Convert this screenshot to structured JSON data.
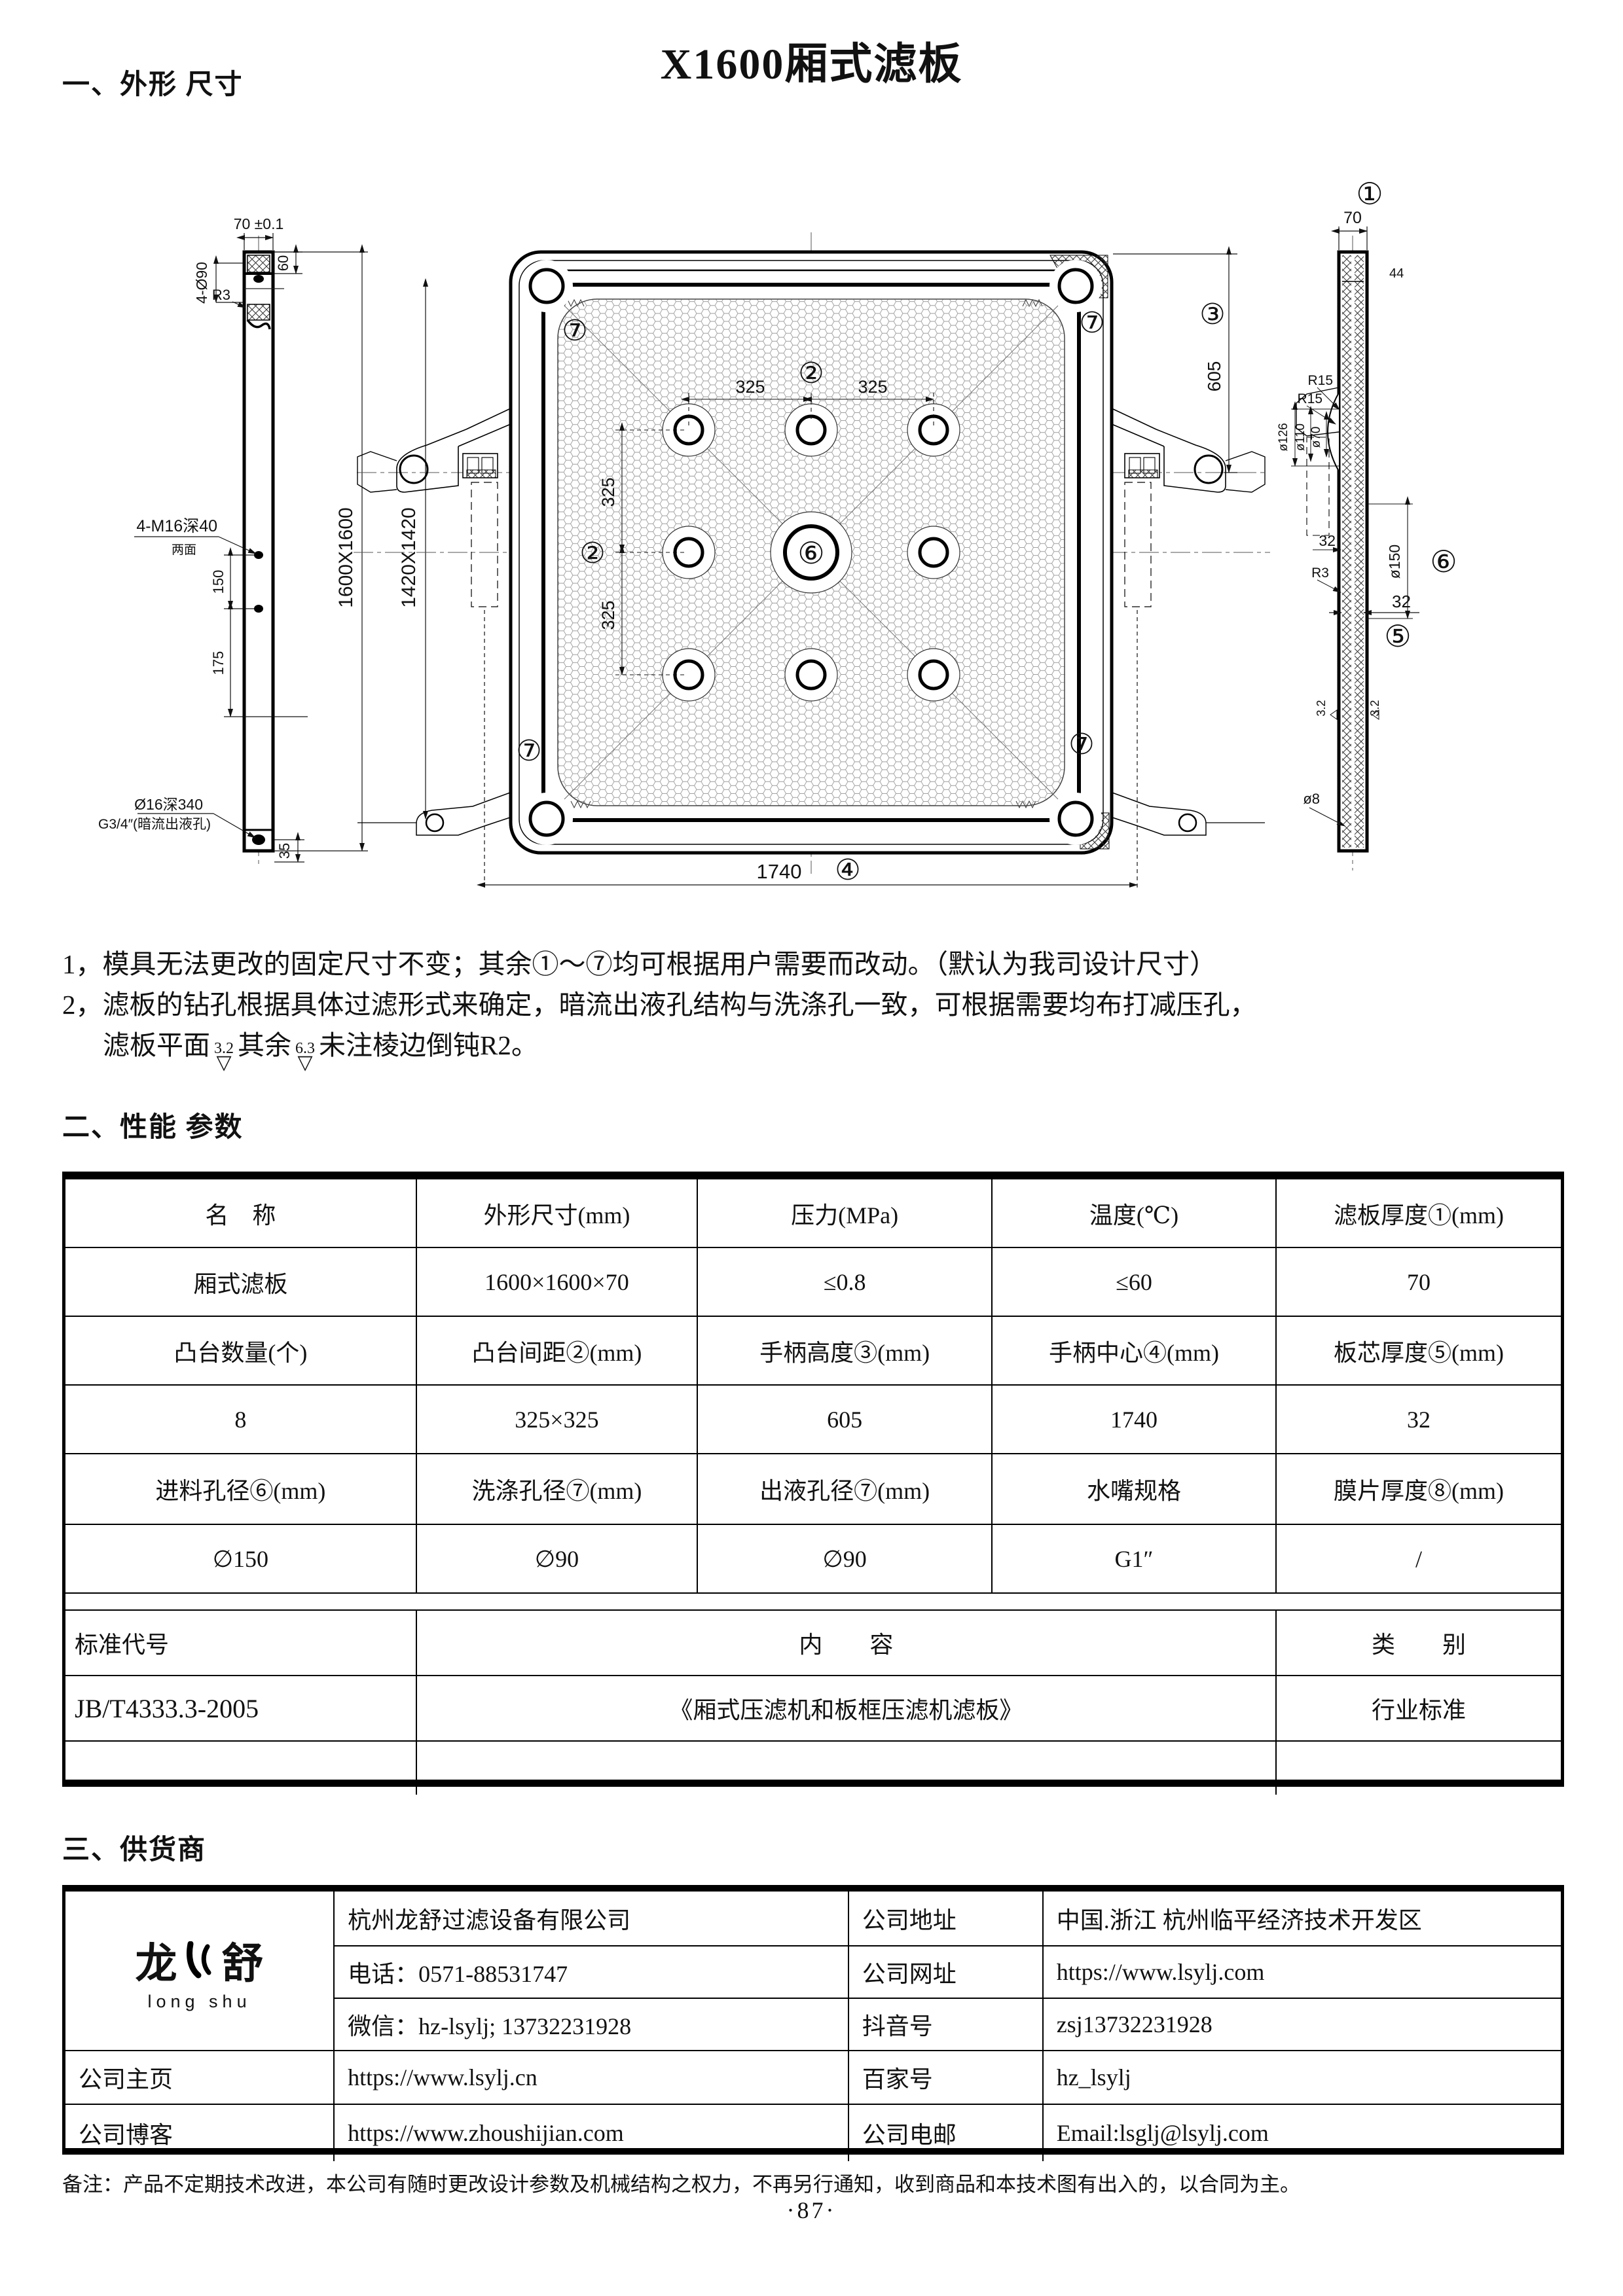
{
  "head": {
    "title": "X1600厢式滤板",
    "s1": "一、外形 尺寸",
    "s2": "二、性能 参数",
    "s3": "三、供货商",
    "footer": "备注：产品不定期技术改进，本公司有随时更改设计参数及机械结构之权力，不再另行通知，收到商品和本技术图有出入的，以合同为主。",
    "page": "·87·"
  },
  "notes": {
    "l1": "1，模具无法更改的固定尺寸不变；其余①～⑦均可根据用户需要而改动。（默认为我司设计尺寸）",
    "l2": "2，滤板的钻孔根据具体过滤形式来确定，暗流出液孔结构与洗涤孔一致，可根据需要均布打减压孔，",
    "l3a": "滤板平面",
    "f1": "3.2",
    "l3b": "其余",
    "f2": "6.3",
    "tri": "▽",
    "l3c": "未注棱边倒钝R2。"
  },
  "perf": {
    "r1": [
      "名　称",
      "外形尺寸(mm)",
      "压力(MPa)",
      "温度(℃)",
      "滤板厚度①(mm)"
    ],
    "r2": [
      "厢式滤板",
      "1600×1600×70",
      "≤0.8",
      "≤60",
      "70"
    ],
    "r3": [
      "凸台数量(个)",
      "凸台间距②(mm)",
      "手柄高度③(mm)",
      "手柄中心④(mm)",
      "板芯厚度⑤(mm)"
    ],
    "r4": [
      "8",
      "325×325",
      "605",
      "1740",
      "32"
    ],
    "r5": [
      "进料孔径⑥(mm)",
      "洗涤孔径⑦(mm)",
      "出液孔径⑦(mm)",
      "水嘴规格",
      "膜片厚度⑧(mm)"
    ],
    "r6": [
      "∅150",
      "∅90",
      "∅90",
      "G1″",
      "/"
    ],
    "std_label": "标准代号",
    "std_content_h": "内　　容",
    "std_class_h": "类　　别",
    "std_code": "JB/T4333.3-2005",
    "std_content": "《厢式压滤机和板框压滤机滤板》",
    "std_class": "行业标准"
  },
  "supplier": {
    "logo_left": "龙",
    "logo_right": "舒",
    "logo_en": "long shu",
    "company": "杭州龙舒过滤设备有限公司",
    "addr_label": "公司地址",
    "addr": "中国.浙江 杭州临平经济技术开发区",
    "phone": "电话：0571-88531747",
    "web_label": "公司网址",
    "web": "https://www.lsylj.com",
    "wechat": "微信：hz-lsylj; 13732231928",
    "douyin_label": "抖音号",
    "douyin": "zsj13732231928",
    "home_label": "公司主页",
    "home": "https://www.lsylj.cn",
    "baijia_label": "百家号",
    "baijia": "hz_lsylj",
    "blog_label": "公司博客",
    "blog": "https://www.zhoushijian.com",
    "email_label": "公司电邮",
    "email": "Email:lsglj@lsylj.com"
  },
  "drawing": {
    "lv": {
      "w": "70 ±0.1",
      "d60": "60",
      "holes": "4-Ø90",
      "r3": "R3",
      "m16": "4-M16深40",
      "m16b": "两面",
      "d150": "150",
      "d175": "175",
      "out1": "Ø16深340",
      "out2": "G3/4″(暗流出液孔)",
      "d35": "35",
      "outer": "1600X1600",
      "inner": "1420X1420"
    },
    "fv": {
      "n2": "②",
      "n3": "③",
      "n4": "④",
      "n6": "⑥",
      "n7": "⑦",
      "d325": "325",
      "d605": "605",
      "d1740": "1740"
    },
    "rv": {
      "n1": "①",
      "n5": "⑤",
      "n6": "⑥",
      "d70": "70",
      "d44": "44",
      "r15": "R15",
      "d126": "ø126",
      "d110": "ø110",
      "d70b": "ø70",
      "d32": "32",
      "d150": "ø150",
      "r3": "R3",
      "fin": "3.2",
      "d8": "ø8"
    }
  }
}
